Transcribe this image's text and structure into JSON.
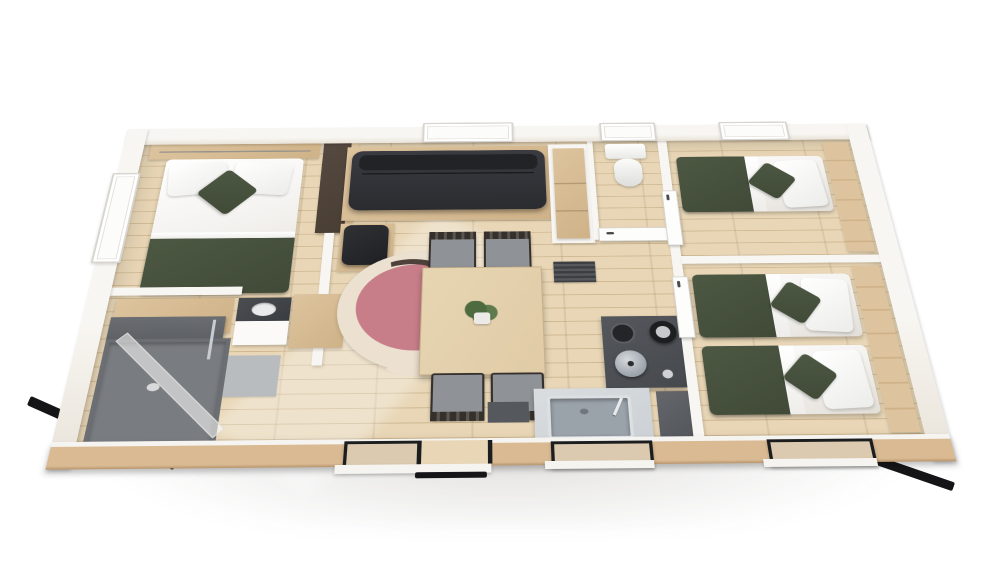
{
  "meta": {
    "title": "3D cutaway floor plan render of a rectangular holiday mobile home",
    "view": "isometric top-down, white studio background, sunlight streak across wood floor",
    "visible_text": "none"
  },
  "scene": {
    "rooms": [
      {
        "name": "master-bedroom",
        "position": "left",
        "furniture": [
          "double bed with white linen",
          "olive-green runner blanket at foot",
          "two white pillows",
          "olive accent cushion",
          "wood headboard shelf with hanging rail",
          "window on left wall",
          "dark-brown wardrobe panel"
        ]
      },
      {
        "name": "bathroom",
        "position": "bottom-left",
        "furniture": [
          "corner shower with grey tray and glass screen",
          "vanity with dark counter and basin",
          "open white shelf unit",
          "wood-top cabinet",
          "wood bench",
          "grey bath mat"
        ]
      },
      {
        "name": "living-dining",
        "position": "center",
        "furniture": [
          "charcoal three-seat sofa on wood plinth",
          "window above sofa",
          "black ottoman pouf on wood base",
          "round rug (cream, pink and dark swirls)",
          "light-wood dining table",
          "potted green plant",
          "four chairs (two slat-back, two grey)",
          "dark slatted doormat",
          "sliding glass entrance door",
          "open doorway with threshold"
        ]
      },
      {
        "name": "wc",
        "position": "top-center-right",
        "furniture": [
          "toilet with cistern",
          "white door with handle",
          "window above"
        ]
      },
      {
        "name": "kitchen",
        "position": "center-right",
        "furniture": [
          "dark cooktop with burners",
          "steel pot",
          "black kettle",
          "tall dark appliance",
          "steel sink with faucet",
          "grey counter",
          "window above sink",
          "dark floor mat",
          "open shelf column with wood interior"
        ]
      },
      {
        "name": "bedroom-2",
        "position": "top-right",
        "furniture": [
          "single bed, olive blanket, white pillows, olive accent cushion",
          "wood shelf strip along right wall",
          "window on top wall",
          "white door"
        ]
      },
      {
        "name": "bedroom-3",
        "position": "bottom-right",
        "furniture": [
          "two single beds, olive blankets, white pillows, olive accent cushions",
          "wood shelf strip along right wall",
          "window on bottom wall",
          "white door"
        ]
      }
    ],
    "exterior": [
      "white walls",
      "wood-clad bottom facade",
      "black base rails at lower corners",
      "soft ground shadow"
    ]
  },
  "colors": {
    "bg": "#ffffff",
    "floor": "#e8d6b6",
    "floorSeam": "#cdb68f",
    "wallFace": "#f8f6f2",
    "wallShade": "#e9e3d9",
    "woodCladding": "#d9ba92",
    "woodLight": "#ddc49e",
    "woodMid": "#cfb288",
    "darkWood": "#493e34",
    "sofa": "#2b2c30",
    "sofaLight": "#3a3b41",
    "cushionGreen": "#4d5843",
    "cushionGreenDk": "#404a37",
    "linen": "#f3f1ee",
    "linenShade": "#e2ded8",
    "rugBase": "#ece1d1",
    "rugPink": "#c87e89",
    "rugDark": "#4e413c",
    "chairSeat": "#8f9296",
    "chairFrame": "#35302c",
    "tableWood": "#e0cba6",
    "plantGreen": "#4d6b3f",
    "potWhite": "#eceae6",
    "cooktop": "#46494e",
    "burnerDark": "#232529",
    "steelLight": "#ccd1d5",
    "steelMid": "#9aa2aa",
    "appliance": "#54575c",
    "showerTray": "#797c80",
    "showerWallDk": "#5e6165",
    "matGray": "#b9bcbe",
    "black": "#151517",
    "glassTint": "rgba(223,215,200,0.55)",
    "frameBlack": "#1c1d1f",
    "sill": "#f6f4f0"
  }
}
